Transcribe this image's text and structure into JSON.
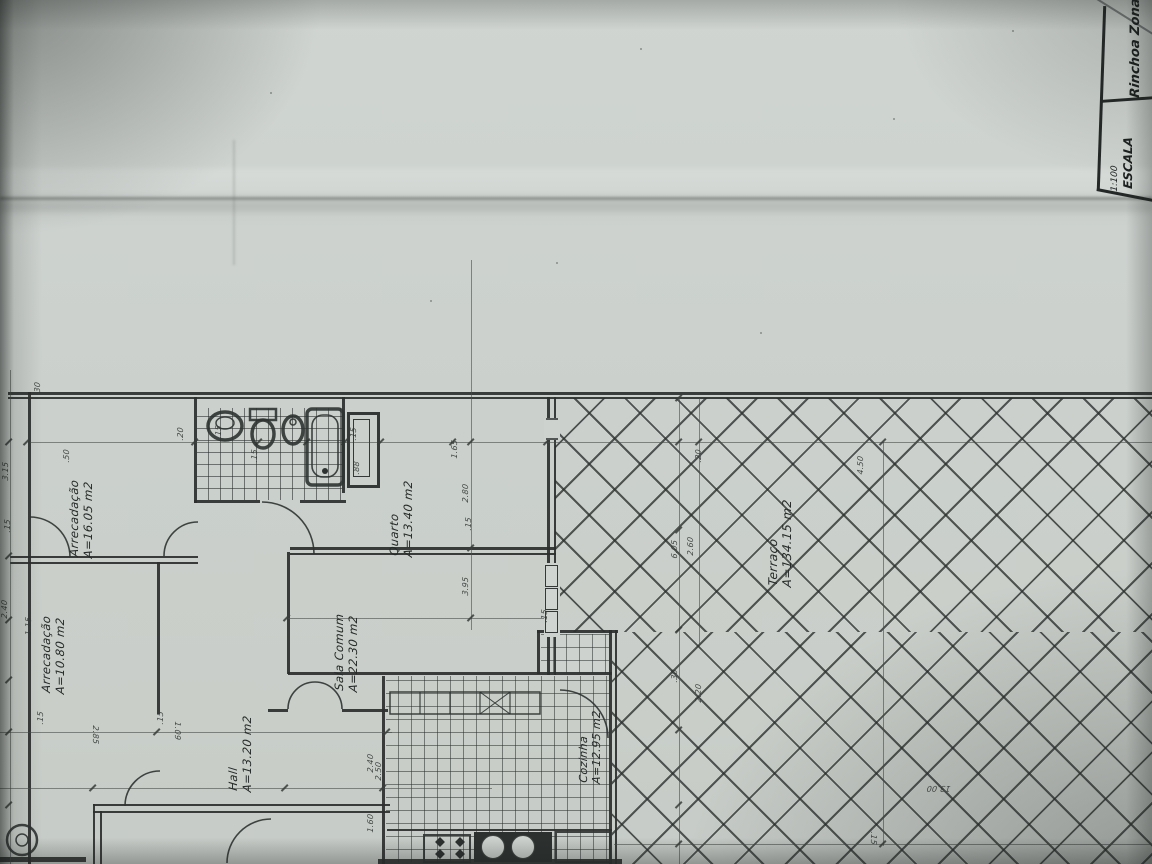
{
  "title_block": {
    "zone_label": "Rinchoa Zona",
    "scale_label": "ESCALA",
    "scale_value": "1:100"
  },
  "rooms": [
    {
      "id": "arrecadacao-1",
      "name": "Arrecadação",
      "area": "A=16.05 m2",
      "x": 68,
      "y": 176,
      "fs": 11.5
    },
    {
      "id": "arrecadacao-2",
      "name": "Arrecadação",
      "area": "A=10.80 m2",
      "x": 40,
      "y": 312,
      "fs": 11.5
    },
    {
      "id": "hall",
      "name": "Hall",
      "area": "A=13.20 m2",
      "x": 227,
      "y": 410,
      "fs": 11.5
    },
    {
      "id": "sala-comum",
      "name": "Sala Comum",
      "area": "A=22.30 m2",
      "x": 333,
      "y": 310,
      "fs": 11.5
    },
    {
      "id": "quarto",
      "name": "Quarto",
      "area": "A=13.40 m2",
      "x": 388,
      "y": 175,
      "fs": 11.5
    },
    {
      "id": "cozinha",
      "name": "Cozinha",
      "area": "A=12.95 m2",
      "x": 578,
      "y": 402,
      "fs": 11
    },
    {
      "id": "terraco",
      "name": "Terraço",
      "area": "A=134.15 m2",
      "x": 766,
      "y": 205,
      "fs": 12
    }
  ],
  "dimensions": [
    {
      "t": "30",
      "x": 33,
      "y": 12
    },
    {
      "t": "3.15",
      "x": 1,
      "y": 100
    },
    {
      "t": ".15",
      "x": 3,
      "y": 152
    },
    {
      "t": "2.40",
      "x": 0,
      "y": 238
    },
    {
      "t": "1.15",
      "x": 24,
      "y": 255
    },
    {
      "t": ".50",
      "x": 62,
      "y": 82
    },
    {
      "t": ".20",
      "x": 176,
      "y": 60
    },
    {
      "t": ".15",
      "x": 214,
      "y": 58
    },
    {
      "t": ".15",
      "x": 250,
      "y": 82
    },
    {
      "t": ".15",
      "x": 349,
      "y": 60
    },
    {
      "t": ".88",
      "x": 352,
      "y": 94
    },
    {
      "t": "1.65",
      "x": 450,
      "y": 78
    },
    {
      "t": "2.80",
      "x": 461,
      "y": 122
    },
    {
      "t": ".15",
      "x": 464,
      "y": 150
    },
    {
      "t": "3.95",
      "x": 461,
      "y": 215
    },
    {
      "t": ".15",
      "x": 540,
      "y": 242
    },
    {
      "t": "2.50",
      "x": 374,
      "y": 400
    },
    {
      "t": "2.85",
      "x": 100,
      "y": 346,
      "r": 90
    },
    {
      "t": "1.09",
      "x": 182,
      "y": 342,
      "r": 90
    },
    {
      "t": ".15",
      "x": 36,
      "y": 344
    },
    {
      "t": ".15",
      "x": 156,
      "y": 344
    },
    {
      "t": "2.40",
      "x": 366,
      "y": 392
    },
    {
      "t": "1.60",
      "x": 366,
      "y": 452
    },
    {
      "t": ".20",
      "x": 694,
      "y": 82
    },
    {
      "t": "2.60",
      "x": 686,
      "y": 175
    },
    {
      "t": "6.05",
      "x": 670,
      "y": 178
    },
    {
      "t": "2.20",
      "x": 694,
      "y": 322
    },
    {
      "t": ".30",
      "x": 670,
      "y": 302
    },
    {
      "t": "4.50",
      "x": 856,
      "y": 94
    },
    {
      "t": "13.00",
      "x": 950,
      "y": 413,
      "r": 180
    },
    {
      "t": ".15",
      "x": 878,
      "y": 452,
      "r": 90
    }
  ],
  "colors": {
    "paper": "#cdd2ce",
    "ink": "#2b2f2e",
    "hatch": "#2b302e",
    "shadow": "#1c201e"
  }
}
